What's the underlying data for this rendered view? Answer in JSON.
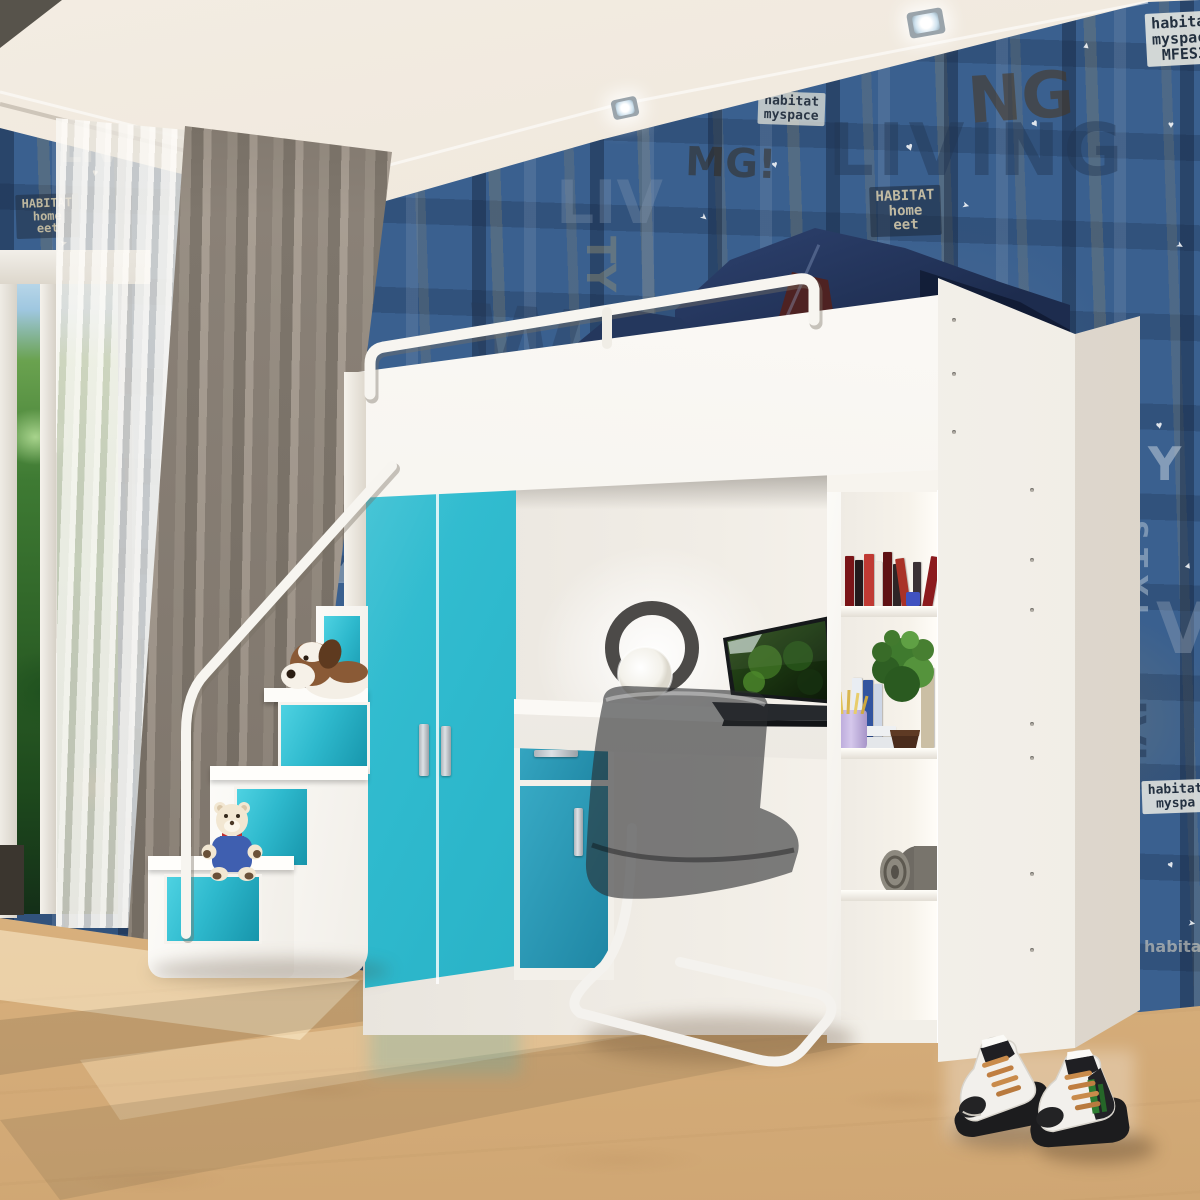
{
  "scene": {
    "description": "3D rendered kids bedroom: white loft bed with guard rail and denim bedding, teal two-door wardrobe, storage staircase with plush dog and teddy bear, white desk with laptop and ring lamp, smoked acrylic cantilever chair, open bookshelf with books, plant, pencil cup and blanket roll, blue grunge typographic wallpaper, beech wood floor, gray and sheer curtains, high-top sneakers on the floor."
  },
  "palette": {
    "wallpaper_blue": "#3a608f",
    "wallpaper_navy": "#1f3a5e",
    "teal_front": "#2eb9cd",
    "teal_shaded": "#1f86a4",
    "furniture_white": "#f8f6f2",
    "ceiling_cream": "#ece4d7",
    "curtain_gray": "#8a8177",
    "floor_beech": "#e4bd8c",
    "denim": "#293f69",
    "maroon_cushion": "#4e2222",
    "chair_smoke": "rgba(42,44,46,0.6)",
    "lace_tan": "#c98b4b",
    "sneaker_green": "#2e7d32"
  },
  "wallpaper": {
    "words": [
      {
        "t": "LIVING",
        "x": 468,
        "y": 6,
        "s": 96,
        "r": -2,
        "c": "rgba(175,165,130,0.30)",
        "ls": 6
      },
      {
        "t": "LIVING",
        "x": 828,
        "y": 118,
        "s": 72,
        "r": 0,
        "c": "rgba(35,55,85,0.45)",
        "ls": 4
      },
      {
        "t": "NG",
        "x": 966,
        "y": 74,
        "s": 64,
        "r": -4,
        "c": "rgba(72,52,30,0.55)",
        "ls": 0
      },
      {
        "t": "MG!",
        "x": 686,
        "y": 144,
        "s": 40,
        "r": 2,
        "c": "rgba(50,38,22,0.50)",
        "ls": 0
      },
      {
        "t": "NY",
        "x": 742,
        "y": 50,
        "s": 34,
        "r": -6,
        "c": "rgba(195,190,165,0.50)",
        "ls": 0
      },
      {
        "t": "LI",
        "x": 398,
        "y": 66,
        "s": 70,
        "r": 0,
        "c": "rgba(120,140,165,0.45)",
        "ls": 0
      },
      {
        "t": "W",
        "x": 468,
        "y": 296,
        "s": 108,
        "r": 4,
        "c": "rgba(40,60,90,0.40)",
        "ls": 0
      },
      {
        "t": "LIV",
        "x": 556,
        "y": 176,
        "s": 60,
        "r": 0,
        "c": "rgba(130,150,175,0.35)",
        "ls": 0
      },
      {
        "t": "TY",
        "x": 618,
        "y": 236,
        "s": 40,
        "r": 90,
        "c": "rgba(160,150,110,0.40)",
        "ls": 0
      },
      {
        "t": "S T Y",
        "x": 290,
        "y": 212,
        "s": 22,
        "r": 0,
        "c": "rgba(200,210,220,0.50)",
        "ls": 6
      },
      {
        "t": "V",
        "x": 298,
        "y": 298,
        "s": 84,
        "r": 8,
        "c": "rgba(150,160,140,0.35)",
        "ls": 0
      },
      {
        "t": "LIV",
        "x": 294,
        "y": 418,
        "s": 40,
        "r": 90,
        "c": "rgba(170,180,195,0.40)",
        "ls": 0
      },
      {
        "t": "Y",
        "x": 328,
        "y": 556,
        "s": 36,
        "r": 0,
        "c": "rgba(200,210,220,0.45)",
        "ls": 0
      },
      {
        "t": "space",
        "x": 1144,
        "y": 330,
        "s": 24,
        "r": 90,
        "c": "rgba(205,200,180,0.55)",
        "ls": 2
      },
      {
        "t": "Y",
        "x": 1148,
        "y": 444,
        "s": 46,
        "r": 0,
        "c": "rgba(205,215,225,0.50)",
        "ls": 0
      },
      {
        "t": "STYL",
        "x": 1150,
        "y": 520,
        "s": 28,
        "r": 90,
        "c": "rgba(205,215,225,0.45)",
        "ls": 8
      },
      {
        "t": "V",
        "x": 1156,
        "y": 598,
        "s": 70,
        "r": 0,
        "c": "rgba(150,165,185,0.40)",
        "ls": 0
      },
      {
        "t": "IVI",
        "x": 1148,
        "y": 700,
        "s": 40,
        "r": 90,
        "c": "rgba(30,48,75,0.50)",
        "ls": 0
      },
      {
        "t": "habita",
        "x": 1144,
        "y": 940,
        "s": 16,
        "r": 0,
        "c": "rgba(215,210,195,0.60)",
        "ls": 0
      },
      {
        "t": "LIV",
        "x": 60,
        "y": 136,
        "s": 34,
        "r": 0,
        "c": "rgba(180,190,205,0.50)",
        "ls": 0
      }
    ],
    "patches": [
      {
        "x": 1146,
        "y": 12,
        "r": -3,
        "s": 15,
        "bg": "rgba(238,238,230,0.85)",
        "fg": "#23303f",
        "lines": [
          "habitat",
          "myspace",
          "MFES3"
        ]
      },
      {
        "x": 758,
        "y": 92,
        "r": 2,
        "s": 13,
        "bg": "rgba(225,225,215,0.75)",
        "fg": "#2a3645",
        "lines": [
          "habitat",
          "myspace"
        ]
      },
      {
        "x": 870,
        "y": 186,
        "r": -2,
        "s": 14,
        "bg": "rgba(28,40,58,0.55)",
        "fg": "rgba(210,200,170,0.9)",
        "lines": [
          "HABITAT",
          "home",
          "eet"
        ]
      },
      {
        "x": 292,
        "y": 358,
        "r": 3,
        "s": 10,
        "bg": "rgba(215,215,205,0.60)",
        "fg": "#2a3645",
        "lines": [
          "habitat",
          "myspace"
        ]
      },
      {
        "x": 1142,
        "y": 780,
        "r": -2,
        "s": 13,
        "bg": "rgba(235,235,228,0.85)",
        "fg": "#233040",
        "lines": [
          "habitat",
          "myspa"
        ]
      },
      {
        "x": 16,
        "y": 194,
        "r": -2,
        "s": 12,
        "bg": "rgba(30,42,60,0.50)",
        "fg": "rgba(205,195,165,0.9)",
        "lines": [
          "HABITAT",
          "home",
          "eet"
        ]
      }
    ],
    "specks": [
      {
        "x": 500,
        "y": 40,
        "s": 11,
        "r": 20,
        "ch": "♥"
      },
      {
        "x": 562,
        "y": 120,
        "s": 9,
        "r": -30,
        "ch": "▲"
      },
      {
        "x": 640,
        "y": 58,
        "s": 12,
        "r": 10,
        "ch": "♥"
      },
      {
        "x": 700,
        "y": 212,
        "s": 9,
        "r": 40,
        "ch": "➤"
      },
      {
        "x": 772,
        "y": 160,
        "s": 10,
        "r": -15,
        "ch": "♥"
      },
      {
        "x": 852,
        "y": 58,
        "s": 9,
        "r": 25,
        "ch": "▲"
      },
      {
        "x": 906,
        "y": 140,
        "s": 12,
        "r": -20,
        "ch": "♥"
      },
      {
        "x": 962,
        "y": 200,
        "s": 9,
        "r": 15,
        "ch": "➤"
      },
      {
        "x": 1032,
        "y": 118,
        "s": 11,
        "r": -35,
        "ch": "♥"
      },
      {
        "x": 1082,
        "y": 40,
        "s": 9,
        "r": 10,
        "ch": "▲"
      },
      {
        "x": 1168,
        "y": 120,
        "s": 10,
        "r": 0,
        "ch": "♥"
      },
      {
        "x": 1176,
        "y": 240,
        "s": 9,
        "r": 30,
        "ch": "➤"
      },
      {
        "x": 1156,
        "y": 420,
        "s": 11,
        "r": -10,
        "ch": "♥"
      },
      {
        "x": 1184,
        "y": 560,
        "s": 9,
        "r": 20,
        "ch": "▲"
      },
      {
        "x": 1168,
        "y": 860,
        "s": 10,
        "r": -25,
        "ch": "♥"
      },
      {
        "x": 1188,
        "y": 918,
        "s": 9,
        "r": 10,
        "ch": "➤"
      },
      {
        "x": 300,
        "y": 250,
        "s": 10,
        "r": 15,
        "ch": "♥"
      },
      {
        "x": 312,
        "y": 500,
        "s": 9,
        "r": -20,
        "ch": "▲"
      },
      {
        "x": 92,
        "y": 168,
        "s": 10,
        "r": 10,
        "ch": "♥"
      },
      {
        "x": 60,
        "y": 238,
        "s": 9,
        "r": -15,
        "ch": "➤"
      }
    ]
  },
  "ceiling": {
    "lights": [
      {
        "x": 332,
        "y": 168,
        "w": 30,
        "h": 22,
        "r": -14
      },
      {
        "x": 612,
        "y": 98,
        "w": 26,
        "h": 20,
        "r": -12
      },
      {
        "x": 908,
        "y": 10,
        "w": 36,
        "h": 26,
        "r": -10
      }
    ]
  },
  "panel_screws": [
    {
      "x": 1030,
      "ys": [
        488,
        558,
        608,
        722,
        756,
        872,
        948
      ]
    },
    {
      "x": 952,
      "ys": [
        318,
        372,
        430
      ]
    }
  ],
  "bookshelf": {
    "top_books": [
      {
        "x": 845,
        "w": 9,
        "h": 52,
        "c": "#7a1417",
        "lean": 0
      },
      {
        "x": 855,
        "w": 8,
        "h": 48,
        "c": "#23191b",
        "lean": 0
      },
      {
        "x": 864,
        "w": 10,
        "h": 54,
        "c": "#c03a33",
        "lean": 0
      },
      {
        "x": 875,
        "w": 7,
        "h": 46,
        "c": "#efe8df",
        "lean": 0
      },
      {
        "x": 883,
        "w": 9,
        "h": 56,
        "c": "#5f1113",
        "lean": 0
      },
      {
        "x": 893,
        "w": 8,
        "h": 44,
        "c": "#2e2527",
        "lean": 0
      },
      {
        "x": 902,
        "w": 9,
        "h": 50,
        "c": "#a93227",
        "lean": -8
      },
      {
        "x": 913,
        "w": 8,
        "h": 46,
        "c": "#3b3135",
        "lean": 0
      },
      {
        "x": 922,
        "w": 10,
        "h": 52,
        "c": "#8c1b1e",
        "lean": 10
      }
    ],
    "cube": {
      "x": 906,
      "y": 592,
      "s": 14,
      "c": "#4052c0"
    },
    "mid_books": [
      {
        "x": 852,
        "w": 10,
        "h": 70,
        "c": "#e9edf3",
        "lean": 0
      },
      {
        "x": 863,
        "w": 10,
        "h": 68,
        "c": "#32549f",
        "lean": 0
      },
      {
        "x": 874,
        "w": 8,
        "h": 64,
        "c": "#cdd6e6",
        "lean": 0
      },
      {
        "x": 921,
        "w": 13,
        "h": 80,
        "c": "#cbbfa4",
        "lean": 0
      }
    ]
  }
}
